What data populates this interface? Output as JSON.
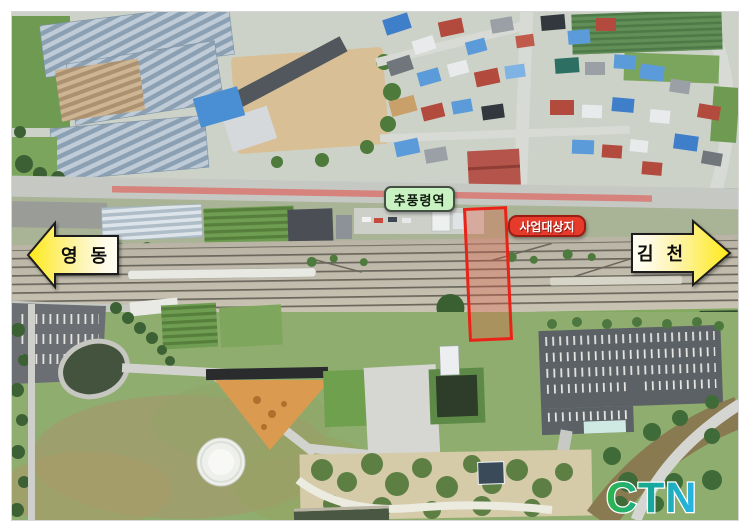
{
  "figure": {
    "description": "Aerial photograph of Chupungnyeong Station area with railway, village and park; project site outlined in red",
    "station_label": {
      "text": "추풍령역",
      "bg_color": "#c9f2c2",
      "border_color": "#454f44",
      "text_color": "#0d1a0d"
    },
    "site_label": {
      "text": "사업대상지",
      "bg_color": "#e63a2a",
      "border_color": "#9a1c12",
      "text_color": "#ffffff"
    },
    "site_boundary": {
      "border_color": "#ea2318",
      "fill_color": "rgba(235,85,60,0.30)"
    },
    "direction_arrows": {
      "left": {
        "text": "영 동",
        "fill_color": "#ffe916",
        "outline_color": "#1c1c1c",
        "text_color": "#111111"
      },
      "right": {
        "text": "김 천",
        "fill_color": "#ffe916",
        "outline_color": "#1c1c1c",
        "text_color": "#111111"
      }
    },
    "watermark": {
      "text": "CTN",
      "color_start": "#2db54b",
      "color_end": "#29b5ea",
      "outline_color": "#ffffff"
    }
  }
}
